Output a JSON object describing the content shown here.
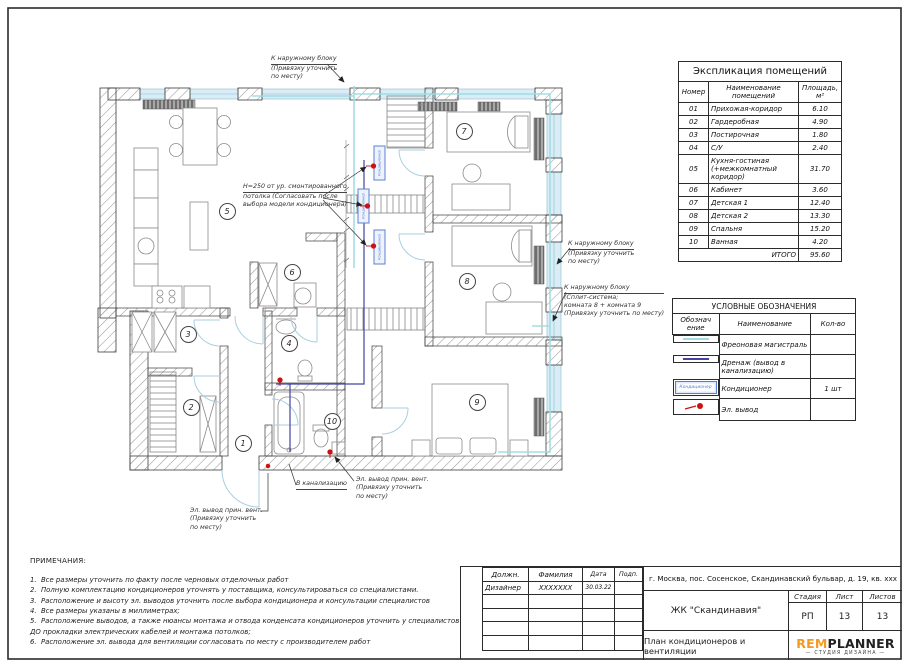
{
  "sheet": {
    "bg": "#ffffff",
    "frame_color": "#2b2b2b"
  },
  "colors": {
    "freon": "#9fdce2",
    "drain": "#4343a0",
    "outlet": "#cc1111",
    "ac_unit": "#5b7fd4",
    "door_arc": "#a9cfe2",
    "logo_orange": "#f49a1f"
  },
  "explication": {
    "title": "Экспликация помещений",
    "headers": {
      "num": "Номер",
      "name": "Наименование помещений",
      "area": "Площадь,\nм²"
    },
    "rows": [
      {
        "num": "01",
        "name": "Прихожая-коридор",
        "area": "6.10"
      },
      {
        "num": "02",
        "name": "Гардеробная",
        "area": "4.90"
      },
      {
        "num": "03",
        "name": "Постирочная",
        "area": "1.80"
      },
      {
        "num": "04",
        "name": "С/У",
        "area": "2.40"
      },
      {
        "num": "05",
        "name": "Кухня-гостиная (+межкомнатный коридор)",
        "area": "31.70"
      },
      {
        "num": "06",
        "name": "Кабинет",
        "area": "3.60"
      },
      {
        "num": "07",
        "name": "Детская 1",
        "area": "12.40"
      },
      {
        "num": "08",
        "name": "Детская 2",
        "area": "13.30"
      },
      {
        "num": "09",
        "name": "Спальня",
        "area": "15.20"
      },
      {
        "num": "10",
        "name": "Ванная",
        "area": "4.20"
      }
    ],
    "total_label": "ИТОГО",
    "total_value": "95.60"
  },
  "legend": {
    "title": "УСЛОВНЫЕ ОБОЗНАЧЕНИЯ",
    "headers": {
      "symbol": "Обознач\nение",
      "name": "Наименование",
      "qty": "Кол-во"
    },
    "rows": [
      {
        "name": "Фреоновая магистраль",
        "qty": ""
      },
      {
        "name": "Дренаж (вывод в канализацию)",
        "qty": ""
      },
      {
        "name": "Кондиционер",
        "qty": "1 шт"
      },
      {
        "name": "Эл. вывод",
        "qty": ""
      }
    ]
  },
  "notes": {
    "title": "ПРИМЕЧАНИЯ:",
    "items": [
      "1.  Все размеры уточнить по факту после черновых отделочных работ",
      "2.  Полную комплектацию кондиционеров уточнять у поставщика, консультироваться со специалистами.",
      "3.  Расположение и высоту эл. выводов уточнить после выбора кондиционера и консультации специалистов",
      "4.  Все размеры указаны в миллиметрах;",
      "5.  Расположение выводов, а также нюансы монтажа и отвода конденсата кондиционеров уточнить у специалистов ДО прокладки электрических кабелей и монтажа потолков;",
      "6.  Расположение эл. вывода для вентиляции согласовать по месту с производителем работ"
    ]
  },
  "plan": {
    "ac_label": "Кондиционер",
    "rooms": [
      "1",
      "2",
      "3",
      "4",
      "5",
      "6",
      "7",
      "8",
      "9",
      "10"
    ],
    "callouts": {
      "to_outdoor_top": {
        "lines": [
          "К наружному блоку",
          "(Привязку уточнить",
          "по месту)"
        ]
      },
      "h250": {
        "lines": [
          "H=250 от ур. смонтированного",
          "потолка (Согласовать после",
          "выбора модели кондиционера)"
        ]
      },
      "to_outdoor_right": {
        "lines": [
          "К наружному блоку",
          "(Привязку уточнить",
          "по месту)"
        ]
      },
      "to_outdoor_split": {
        "lines": [
          "К наружному блоку",
          "(Сплит-система;",
          "комната 8 + комната 9",
          "(Привязку уточнить по месту)"
        ]
      },
      "to_sewer": {
        "lines": [
          "В канализацию"
        ]
      },
      "vent_outlet_right": {
        "lines": [
          "Эл. вывод прин. вент.",
          "(Привязку уточнить",
          "по месту)"
        ]
      },
      "vent_outlet_left": {
        "lines": [
          "Эл. вывод прин. вент.",
          "(Привязку уточнить",
          "по месту)"
        ]
      }
    }
  },
  "titleblock": {
    "col_labels": [
      "Должн.",
      "Фамилия",
      "Дата",
      "Подп."
    ],
    "row": {
      "role": "Дизайнер",
      "name": "XXXXXXX",
      "date": "30.03.22",
      "sign": ""
    },
    "address": "г. Москва, пос. Сосенское, Скандинавский бульвар, д. 19, кв. xxx",
    "project": "ЖК \"Скандинавия\"",
    "stage_label": "Стадия",
    "sheet_label": "Лист",
    "sheets_label": "Листов",
    "stage": "РП",
    "sheet": "13",
    "sheets": "13",
    "drawing_title": "План кондиционеров и вентиляции",
    "logo": {
      "part1": "REM",
      "part2": "PLANNER",
      "subtitle": "СТУДИЯ ДИЗАЙНА"
    }
  }
}
